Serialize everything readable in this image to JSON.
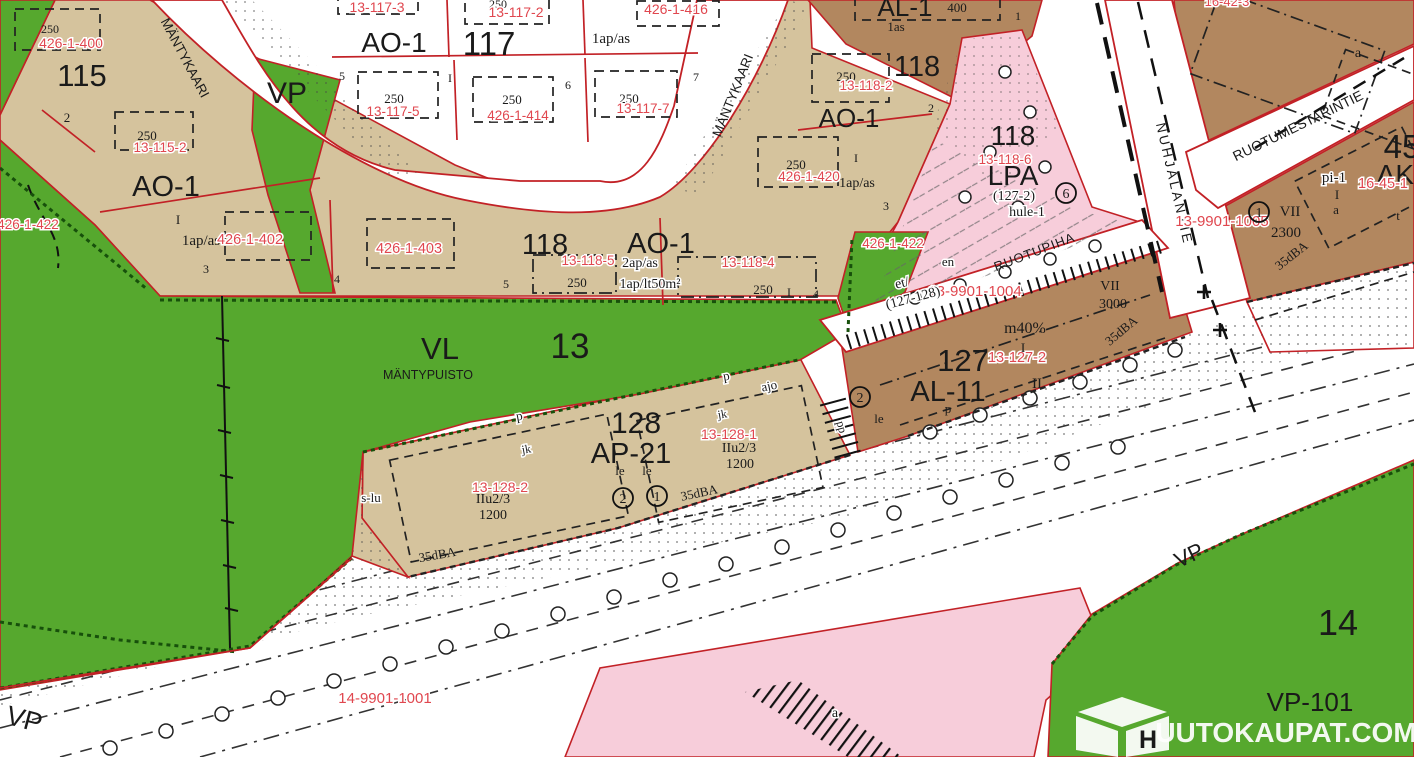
{
  "t": {
    "b115": "115",
    "b117": "117",
    "b118": "118",
    "b127": "127",
    "b128": "128",
    "d13": "13",
    "d14": "14",
    "d45": "45",
    "ao1": "AO-1",
    "ap21": "AP-21",
    "al1": "AL-1",
    "al11": "AL-11",
    "ak": "AK-",
    "lpa": "LPA",
    "vl": "VL",
    "vp": "VP",
    "vp101": "VP-101",
    "mantypuisto": "MÄNTYPUISTO",
    "mantykaari": "MÄNTYKAARI",
    "ruotupiha": "RUOTUPIHA",
    "nuhjalantie": "NUHJALANTIE",
    "ruotumestarintie": "RUOTUMESTARINTIE",
    "p250": "250",
    "p400": "400",
    "p1200": "1200",
    "p2300": "2300",
    "p3000": "3000",
    "ap1": "1ap/as",
    "ap2": "2ap/as",
    "aplt": "1ap/lt50m²",
    "as1": "1as",
    "m40": "m40%",
    "iiu": "IIu2/3",
    "dba": "35dBA",
    "hule": "hule-1",
    "pi1": "pi-1",
    "slu": "s-lu",
    "et": "et/",
    "g127128": "(127-128)",
    "g1272": "(127-2)",
    "en": "en",
    "le": "le",
    "jk": "jk",
    "p": "p",
    "pp": "pp",
    "ajo": "ajo",
    "a": "a",
    "t": "t",
    "rn1": "I",
    "rn2": "II",
    "rn7": "VII",
    "n1": "1",
    "n2": "2",
    "n3": "3",
    "n4": "4",
    "n5": "5",
    "n6": "6",
    "n7": "7",
    "r4261400": "426-1-400",
    "r4261402": "426-1-402",
    "r4261403": "426-1-403",
    "r4261414": "426-1-414",
    "r4261416": "426-1-416",
    "r4261420": "426-1-420",
    "r4261422": "426-1-422",
    "r131152": "13-115-2",
    "r131173": "13-117-3",
    "r131172": "13-117-2",
    "r131175": "13-117-5",
    "r131177": "13-117-7",
    "r131182": "13-118-2",
    "r131184": "13-118-4",
    "r131185": "13-118-5",
    "r131186": "13-118-6",
    "r131272": "13-127-2",
    "r131281": "13-128-1",
    "r131282": "13-128-2",
    "r1399011004": "13-9901-1004",
    "r1399011005": "13-9901-1005",
    "r1499011001": "14-9901-1001",
    "r16451": "16-45-1",
    "r16423": "16-42-3"
  },
  "watermark": {
    "initial": "H",
    "rest": "UUTOKAUPAT.COM"
  },
  "colors": {
    "park_green": "#56a82e",
    "block_tan": "#d5c39d",
    "parking_pink": "#f7cdda",
    "center_brown": "#b2875f",
    "boundary_red": "#c22126",
    "registry_red": "#e0474f",
    "road_white": "#ffffff",
    "forest_edge": "#17500b"
  }
}
